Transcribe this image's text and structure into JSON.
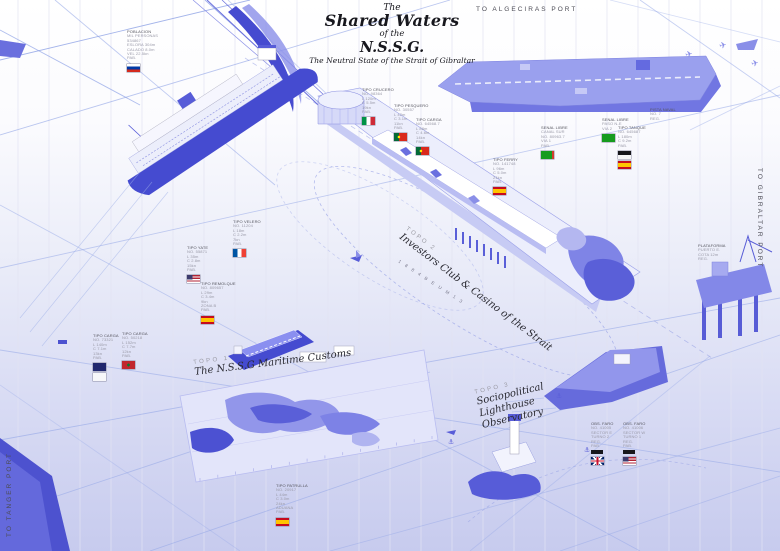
{
  "title": {
    "pre": "The",
    "main": "Shared Waters",
    "mid": "of the",
    "acronym": "N.S.S.G.",
    "subtitle": "The Neutral State of the Strait of Gibraltar"
  },
  "port_labels": {
    "algeciras": "TO ALGECIRAS PORT",
    "gibraltar": "TO GIBRALTAR PORT",
    "tanger": "TO TANGER PORT"
  },
  "topo_labels": [
    {
      "tag": "TOPO 1",
      "name1": "The N.S.S.G Maritime Customs",
      "name2": "",
      "name3": ""
    },
    {
      "tag": "TOPO 2",
      "name1": "Investors Club & Casino of the Strait",
      "name2": "",
      "name3": ""
    },
    {
      "tag": "TOPO 3",
      "name1": "Sociopolitical",
      "name2": "Lighthouse",
      "name3": "Observatory"
    }
  ],
  "pier_edge_text": "1 8 8 4   B E   U M   1 3",
  "icons": {
    "anchor_glyph": "⚓",
    "airplane_glyph": "✈"
  },
  "markers": [
    {
      "x": 127,
      "y": 30,
      "flags": [
        "russia"
      ],
      "bar": false,
      "lines": [
        "POBLACION",
        "MIL PERSONAS",
        "534867",
        "ESLORA 304m",
        "CALADO 8.0m",
        "VEL 22.5kn",
        "PAB."
      ]
    },
    {
      "x": 362,
      "y": 88,
      "flags": [
        "italy"
      ],
      "bar": false,
      "lines": [
        "TIPO CRUCERO",
        "NO. 98364",
        "L 120m",
        "C 5.5m",
        "19kn",
        "PAB."
      ]
    },
    {
      "x": 394,
      "y": 104,
      "flags": [
        "portugal"
      ],
      "bar": false,
      "lines": [
        "TIPO PESQUERO",
        "NO. 30557",
        "L 42m",
        "C 3.1m",
        "11kn",
        "PAB."
      ]
    },
    {
      "x": 416,
      "y": 118,
      "flags": [
        "portugal"
      ],
      "bar": false,
      "lines": [
        "TIPO CARGA",
        "NO. 64568.7",
        "L 88m",
        "C 4.6m",
        "14kn",
        "PAB."
      ]
    },
    {
      "x": 602,
      "y": 118,
      "flags": [
        "green"
      ],
      "bar": false,
      "lines": [
        "SENAL LIBRE",
        "PASO N-E",
        "VIA 2"
      ]
    },
    {
      "x": 541,
      "y": 126,
      "flags": [
        "greenred"
      ],
      "bar": false,
      "lines": [
        "SENAL LIBRE",
        "CANAL SUR",
        "NO. 80963.7",
        "VIA 1",
        "PAB."
      ]
    },
    {
      "x": 618,
      "y": 126,
      "flags": [
        "blackwhite",
        "spain"
      ],
      "bar": false,
      "lines": [
        "TIPO TANQUE",
        "NO. 645687",
        "L 180m",
        "C 9.2m",
        "PAB."
      ]
    },
    {
      "x": 493,
      "y": 158,
      "flags": [
        "spain"
      ],
      "bar": false,
      "lines": [
        "TIPO FERRY",
        "NO. 141748",
        "L 96m",
        "C 5.0m",
        "21kn",
        "PAB."
      ]
    },
    {
      "x": 233,
      "y": 220,
      "flags": [
        "france"
      ],
      "bar": false,
      "lines": [
        "TIPO VELERO",
        "NO. 11204",
        "L 18m",
        "C 2.2m",
        "7kn",
        "PAB."
      ]
    },
    {
      "x": 187,
      "y": 246,
      "flags": [
        "usa"
      ],
      "bar": false,
      "lines": [
        "TIPO YATE",
        "NO. 55871",
        "L 35m",
        "C 2.8m",
        "15kn",
        "PAB."
      ]
    },
    {
      "x": 201,
      "y": 282,
      "flags": [
        "spain"
      ],
      "bar": false,
      "lines": [
        "TIPO REMOLQUE",
        "NO. 809657",
        "L 29m",
        "C 3.4m",
        "9kn",
        "ZONA B",
        "PAB."
      ]
    },
    {
      "x": 93,
      "y": 334,
      "flags": [
        "navy",
        "white"
      ],
      "bar": false,
      "lines": [
        "TIPO CARGA",
        "NO. 73321",
        "L 140m",
        "C 7.1m",
        "13kn",
        "PAB."
      ]
    },
    {
      "x": 122,
      "y": 332,
      "flags": [
        "morocco"
      ],
      "bar": false,
      "lines": [
        "TIPO CARGA",
        "NO. 50218",
        "L 152m",
        "C 7.7m",
        "12kn",
        "PAB."
      ]
    },
    {
      "x": 276,
      "y": 484,
      "flags": [
        "spain"
      ],
      "bar": false,
      "lines": [
        "TIPO PATRULLA",
        "NO. 20917",
        "L 44m",
        "C 3.0m",
        "24kn",
        "ADUANA",
        "PAB."
      ]
    },
    {
      "x": 591,
      "y": 422,
      "flags": [
        "uk"
      ],
      "bar": true,
      "lines": [
        "OBS. FARO",
        "NO. 41005",
        "SECTOR E",
        "TURNO 2",
        "REG.",
        "PAB."
      ]
    },
    {
      "x": 623,
      "y": 422,
      "flags": [
        "usa"
      ],
      "bar": true,
      "lines": [
        "OBS. FARO",
        "NO. 41006",
        "SECTOR W",
        "TURNO 1",
        "REG.",
        "PAB."
      ]
    },
    {
      "x": 698,
      "y": 244,
      "flags": [],
      "bar": false,
      "lines": [
        "PLATAFORMA",
        "PUERTO E.",
        "COTA 12m",
        "REG."
      ]
    },
    {
      "x": 650,
      "y": 108,
      "flags": [],
      "bar": false,
      "lines": [
        "PISTA NAVAL",
        "NO. 7",
        "REG."
      ]
    }
  ],
  "colors": {
    "deep_blue": "#4a4fd2",
    "mid_blue": "#7d82e6",
    "light_blue": "#b9bcf1",
    "pale_blue": "#e4e6fb",
    "route_line": "#8fa3e6",
    "ink": "#1c1c22"
  }
}
